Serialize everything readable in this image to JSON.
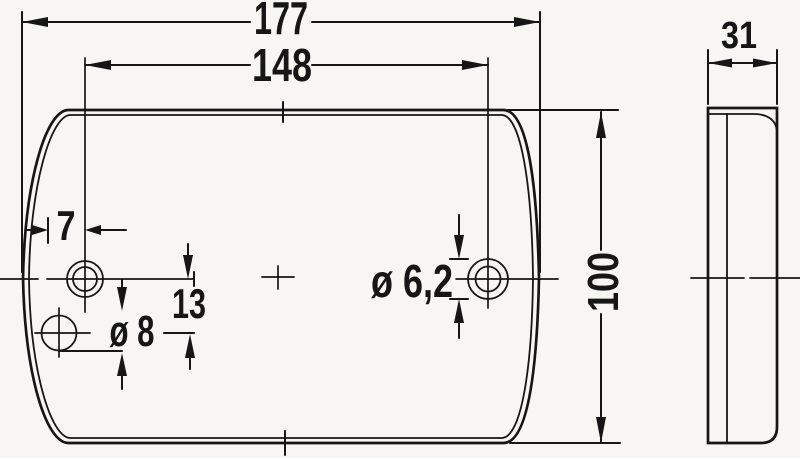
{
  "drawing": {
    "type": "technical-dimension-drawing",
    "views": [
      "front-view",
      "side-view"
    ],
    "units": "mm"
  },
  "labels": {
    "overall_width": "177",
    "hole_spacing": "148",
    "edge_to_hole": "7",
    "hole_vertical_offset": "13",
    "lower_hole_diameter": "ø 8",
    "right_hole_diameter": "ø 6,2",
    "overall_height": "100",
    "depth": "31"
  },
  "colors": {
    "line": "#161616",
    "background": "#f7f6f3"
  }
}
